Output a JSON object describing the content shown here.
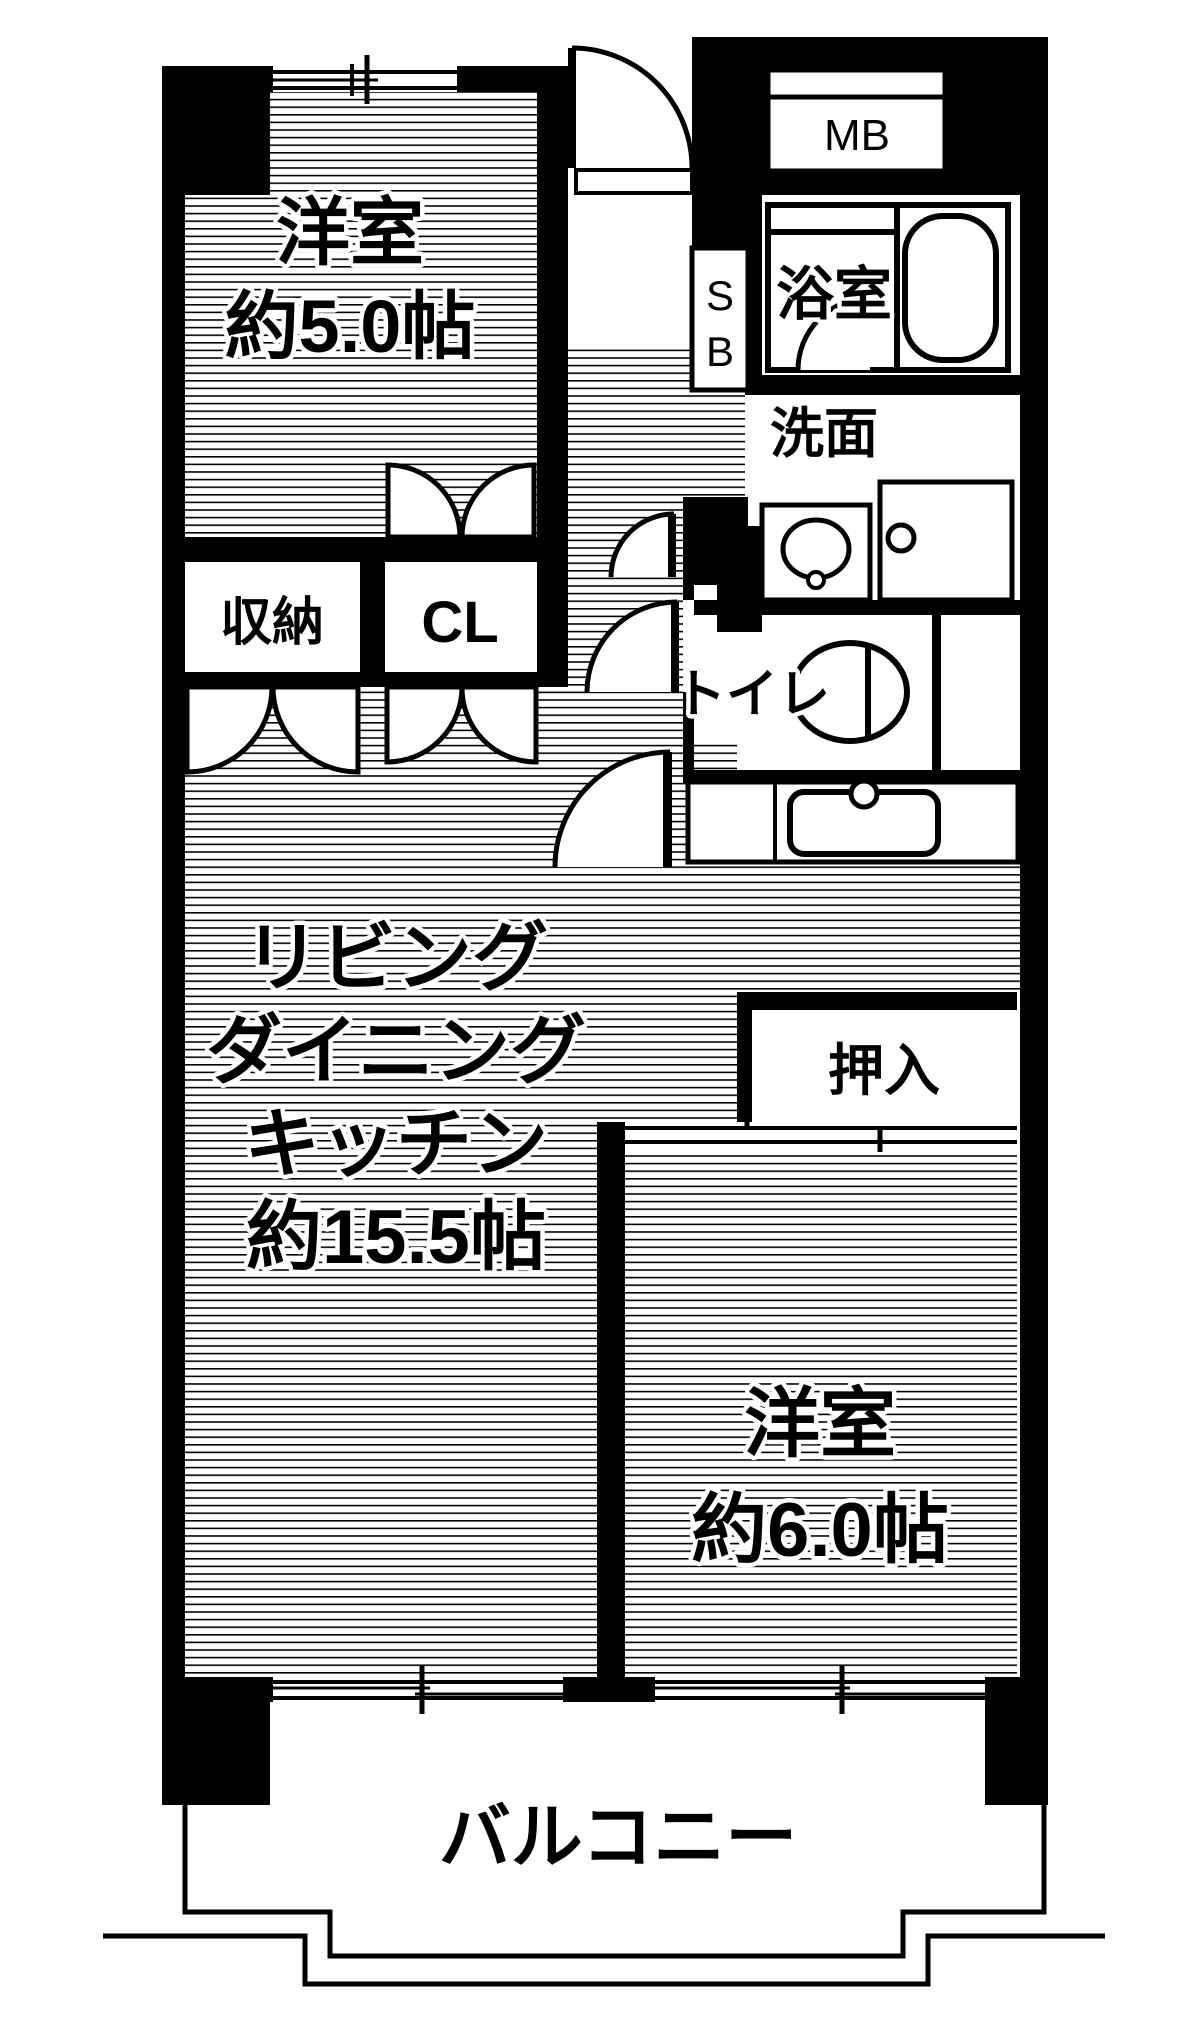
{
  "colors": {
    "wall": "#000000",
    "background": "#ffffff",
    "line": "#000000"
  },
  "rooms": {
    "western5": {
      "name": "洋室",
      "size": "約5.0帖"
    },
    "meter_box": {
      "label": "MB"
    },
    "shoe_box": {
      "line1": "S",
      "line2": "B"
    },
    "bathroom": {
      "label": "浴室"
    },
    "washroom": {
      "label": "洗面"
    },
    "toilet": {
      "label": "トイレ"
    },
    "storage": {
      "label": "収納"
    },
    "closet": {
      "label": "CL"
    },
    "ldk": {
      "line1": "リビング",
      "line2": "ダイニング",
      "line3": "キッチン",
      "line4": "約15.5帖"
    },
    "oshiire": {
      "label": "押入"
    },
    "western6": {
      "name": "洋室",
      "size": "約6.0帖"
    },
    "balcony": {
      "label": "バルコニー"
    }
  }
}
